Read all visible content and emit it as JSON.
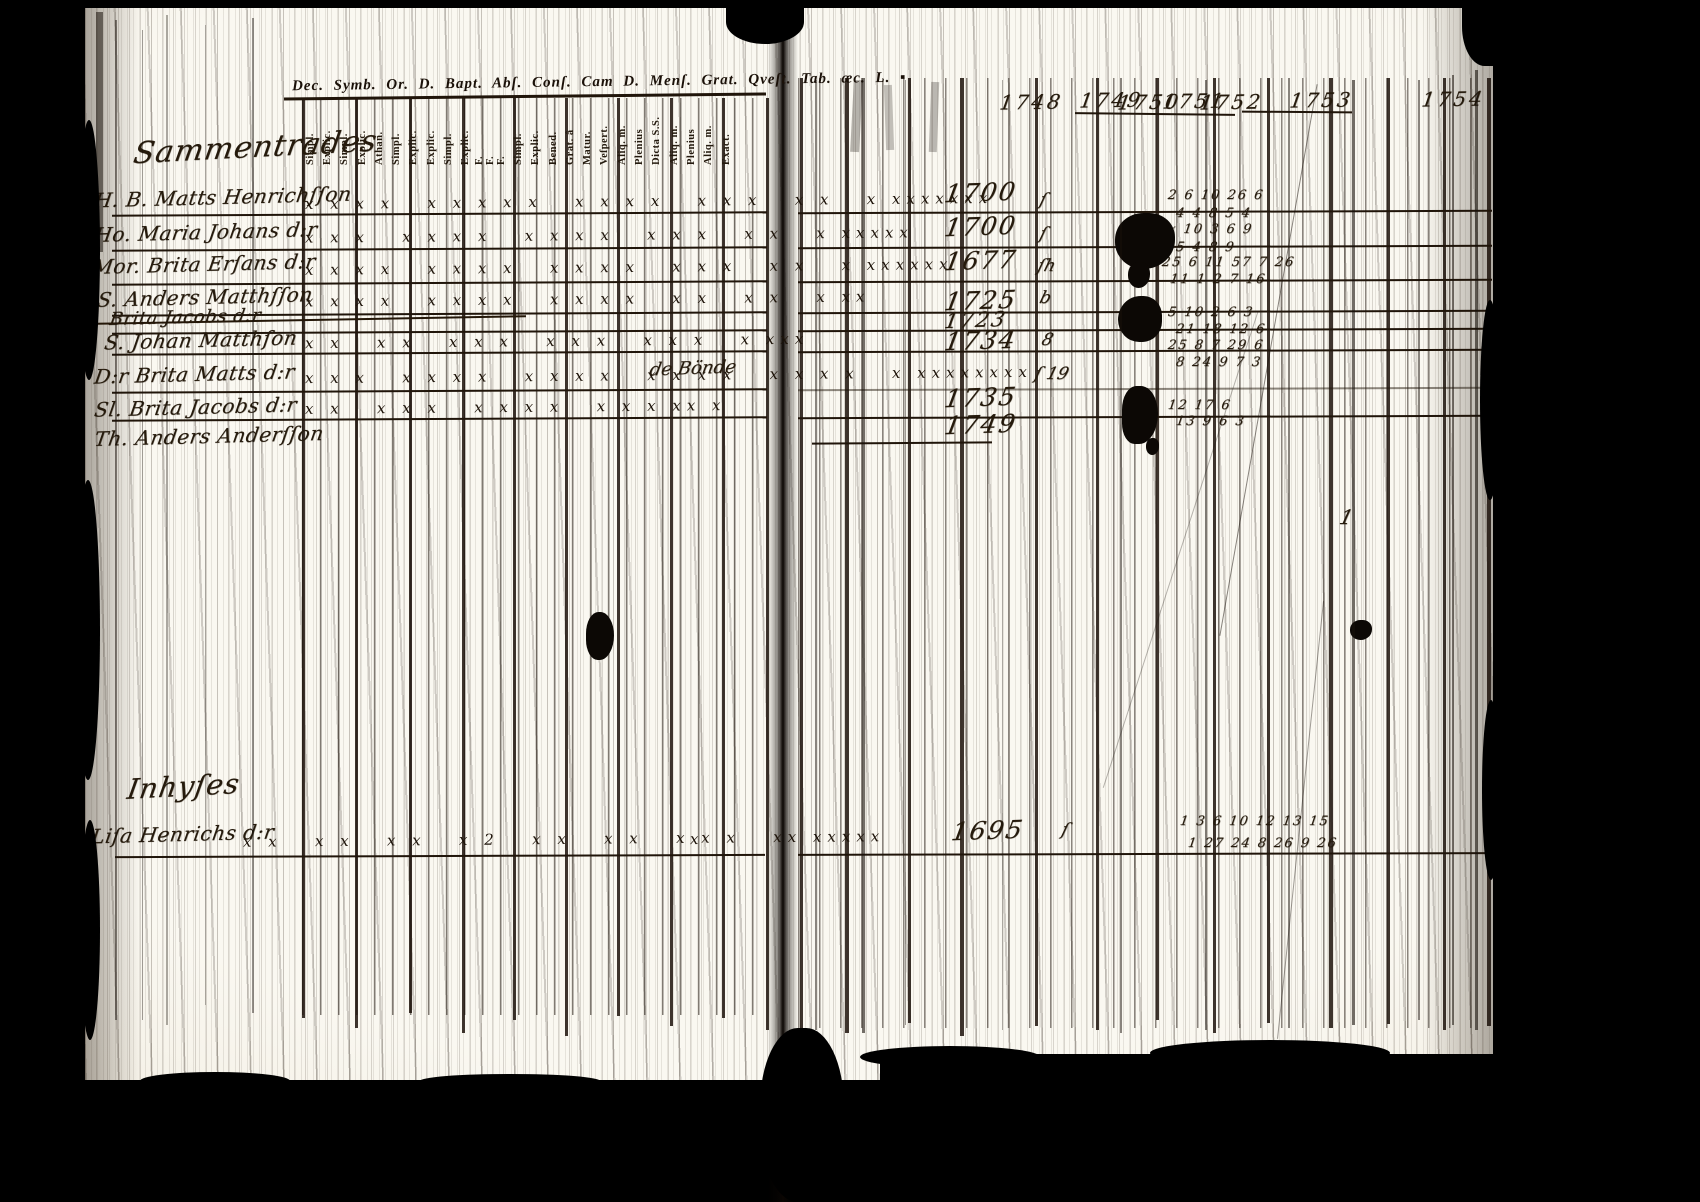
{
  "colors": {
    "background": "#000000",
    "paper": "#f6f2e8",
    "ink": "#1b120a"
  },
  "left_page": {
    "printed_header": "Dec. Symb. Or. D. Bapt. Abſ. Conſ. Cam D. Menſ. Grat. Qveſt. Tab. æc. L. ▪",
    "column_labels": [
      "Simpl.",
      "Explic.",
      "Simpl.",
      "Explic.",
      "Athan.",
      "Simpl.",
      "Explic.",
      "Explic.",
      "Simpl.",
      "Explic.",
      "F.",
      "F.",
      "F.",
      "Simpl.",
      "Explic.",
      "Bened.",
      "Grat. â",
      "Matur.",
      "Veſpert.",
      "Aliq. m.",
      "Plenius",
      "Dicta S.S.",
      "Aliq. m.",
      "Plenius",
      "Aliq. m.",
      "Exact."
    ],
    "section_heading": "Sammentrades",
    "bottom_heading": "Inhyſes"
  },
  "right_page": {
    "year_headers": [
      "1748",
      "1749",
      "1750",
      "1751",
      "1752",
      "1753",
      "1754"
    ],
    "stray_mark": "1"
  },
  "rows": [
    {
      "name": "H. B. Matts Henrichſſon",
      "marks": "x x x x   x x x x x   x x x x   x x x   x x   x xxxxxxx",
      "spine_mark": "ſ",
      "year": "1700",
      "numbers_upper": "2 6 10 26 6",
      "numbers_lower": "4 4 8 5 4"
    },
    {
      "name": "Ho. Maria Johans d:r",
      "marks": "x x x   x x x x   x x x x   x x x   x x   x xxxxx",
      "spine_mark": "ſ",
      "year": "1700",
      "numbers_upper": "x 10 3 6 9",
      "numbers_lower": "5 4 8 9"
    },
    {
      "name": "Mor. Brita Erſans d:r",
      "marks": "x x x x   x x x x   x x x x   x x x   x x   x xxxxxx",
      "spine_mark": "ſh",
      "year": "1677",
      "numbers_upper": "25 6 11 57 7 26",
      "numbers_lower": "11 1 2 7 16"
    },
    {
      "name": "S. Anders Matthſſon",
      "marks": "x x x x   x x x x   x x x x   x x   x x   x xx",
      "spine_mark": "b",
      "year": "1725",
      "numbers_upper": "5 10 2 6 3",
      "numbers_lower": "21 18 12 6"
    },
    {
      "name": "Brita Jacobs d:r",
      "struck": true,
      "marks": "",
      "spine_mark": "",
      "year": "1723",
      "numbers_upper": "",
      "numbers_lower": ""
    },
    {
      "name": "S. Johan Matthſon",
      "marks": "x x   x x   x x x   x x x   x x x   x xxx",
      "spine_mark": "8",
      "year": "1734",
      "numbers_upper": "25 8 7 29 6",
      "numbers_lower": "8 24 9 7 3"
    },
    {
      "name": "D:r Brita Matts d:r",
      "marks": "x x x   x x x x   x x x x   x x x x   x x x x   x xxxxxxxx",
      "annotation": "de Bönde",
      "spine_mark": "ſ 19",
      "year": "",
      "numbers_upper": "",
      "numbers_lower": ""
    },
    {
      "name": "Sl. Brita Jacobs d:r",
      "marks": "x x   x x x   x x x x   x x x xx x",
      "spine_mark": "",
      "year": "1735",
      "numbers_upper": "12 17 6",
      "numbers_lower": "13 9 6 3"
    },
    {
      "name": "Th. Anders Anderſſon",
      "marks": "",
      "spine_mark": "",
      "year": "1749",
      "numbers_upper": "",
      "numbers_lower": ""
    }
  ],
  "bottom_row": {
    "name": "Liſa Henrichs d:r",
    "marks": "x x   x x   x x   x 2   x x   x x   x x x   xx xxxxx",
    "stray_mark_x": "x",
    "spine_mark": "ſ",
    "year": "1695",
    "numbers_upper": "1 3 6 10 12 13 15",
    "numbers_lower": "1 27 24 8 26 9 26"
  }
}
